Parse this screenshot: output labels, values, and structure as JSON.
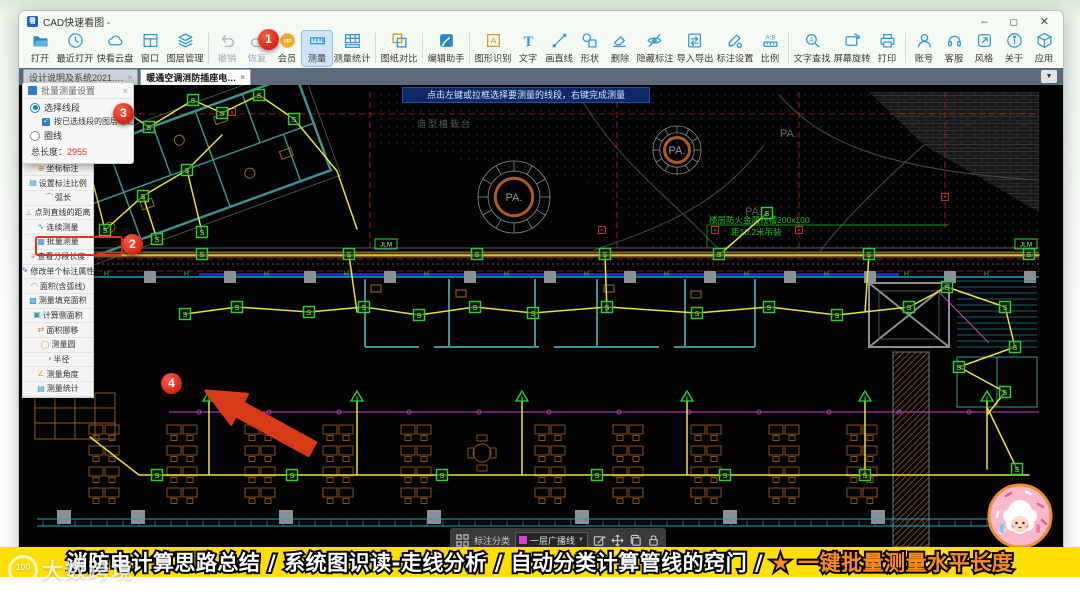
{
  "window": {
    "title": "CAD快速看图 -",
    "app_icon": "kt",
    "controls": {
      "minimize": "–",
      "maximize": "▢",
      "close": "✕"
    }
  },
  "toolbar": {
    "items": [
      {
        "label": "打开",
        "icon": "open-icon"
      },
      {
        "label": "最近打开",
        "icon": "recent-icon"
      },
      {
        "label": "快看云盘",
        "icon": "cloud-icon"
      },
      {
        "label": "窗口",
        "icon": "window-icon"
      },
      {
        "label": "图层管理",
        "icon": "layers-icon",
        "divider_after": true
      },
      {
        "label": "撤销",
        "icon": "undo-icon",
        "disabled": true
      },
      {
        "label": "恢复",
        "icon": "redo-icon",
        "disabled": true
      },
      {
        "label": "会员",
        "icon": "vip-icon"
      },
      {
        "label": "测量",
        "icon": "measure-icon",
        "active": true
      },
      {
        "label": "测量统计",
        "icon": "measure-stats-icon",
        "divider_after": true
      },
      {
        "label": "图纸对比",
        "icon": "compare-icon",
        "divider_after": true
      },
      {
        "label": "编辑助手",
        "icon": "edit-assistant-icon",
        "divider_after": true
      },
      {
        "label": "图形识别",
        "icon": "shape-recognition-icon"
      },
      {
        "label": "文字",
        "icon": "text-icon"
      },
      {
        "label": "画直线",
        "icon": "draw-line-icon"
      },
      {
        "label": "形状",
        "icon": "shapes-icon"
      },
      {
        "label": "删除",
        "icon": "eraser-icon"
      },
      {
        "label": "隐藏标注",
        "icon": "hide-annotations-icon"
      },
      {
        "label": "导入导出",
        "icon": "import-export-icon"
      },
      {
        "label": "标注设置",
        "icon": "annotation-settings-icon"
      },
      {
        "label": "比例",
        "icon": "scale-icon",
        "divider_after": true
      },
      {
        "label": "文字查找",
        "icon": "text-search-icon"
      },
      {
        "label": "屏幕旋转",
        "icon": "screen-rotate-icon"
      },
      {
        "label": "打印",
        "icon": "print-icon",
        "divider_after": true
      },
      {
        "label": "账号",
        "icon": "account-icon"
      },
      {
        "label": "客服",
        "icon": "support-icon"
      },
      {
        "label": "风格",
        "icon": "style-icon"
      },
      {
        "label": "关于",
        "icon": "about-icon"
      },
      {
        "label": "应用",
        "icon": "apps-icon"
      }
    ]
  },
  "tabs": [
    {
      "label": "设计说明及系统2021.…",
      "close": "×",
      "active": false
    },
    {
      "label": "暖通空调消防插座电…",
      "close": "×",
      "active": true
    }
  ],
  "canvas": {
    "tooltip": "点击左键或拉框选择要测量的线段，右键完成测量",
    "labels": {
      "pa": "PA.",
      "planting": "造型植栽台",
      "duct_line1": "楼层防火金属线槽200x100",
      "duct_line2": "距10.2米吊装",
      "device": "S",
      "wall_mark": "H",
      "cable_tag": "JLM"
    }
  },
  "measure_popup": {
    "title": "批量测量设置",
    "close": "×",
    "radio_selected": "选择线段",
    "checkbox_label": "按已选线段的图层过滤",
    "checkbox_mark": "✓",
    "radio_unselected": "圈线",
    "total_label": "总长度：",
    "total_value": "2955"
  },
  "sidebar": {
    "items": [
      {
        "label": "矩形面积",
        "icon": "rect-area-icon",
        "glyph": "▭",
        "color": "#2f8fd0"
      },
      {
        "label": "坐标标注",
        "icon": "coordinate-icon",
        "glyph": "⊕",
        "color": "#e09030"
      },
      {
        "label": "设置标注比例",
        "icon": "annotation-scale-icon",
        "glyph": "▤",
        "color": "#2f8fd0"
      },
      {
        "label": "弧长",
        "icon": "arc-length-icon",
        "glyph": "⌒",
        "color": "#b08030"
      },
      {
        "label": "点到直线的距离",
        "icon": "point-line-distance-icon",
        "glyph": "⊥",
        "color": "#c0a030"
      },
      {
        "label": "连续测量",
        "icon": "continuous-measure-icon",
        "glyph": "∿",
        "color": "#2f8fd0"
      },
      {
        "label": "批量测量",
        "icon": "batch-measure-icon",
        "glyph": "▦",
        "color": "#2f8fd0",
        "highlighted": true
      },
      {
        "label": "查看分段长度",
        "icon": "segment-length-icon",
        "glyph": "≡",
        "color": "#e09030"
      },
      {
        "label": "修改单个标注属性",
        "icon": "modify-annotation-icon",
        "glyph": "✎",
        "color": "#8a5ac0"
      },
      {
        "label": "面积(含弧线)",
        "icon": "area-with-arc-icon",
        "glyph": "◠",
        "color": "#c08a30"
      },
      {
        "label": "测量填充面积",
        "icon": "fill-area-icon",
        "glyph": "▩",
        "color": "#2f8fd0"
      },
      {
        "label": "计算侧面积",
        "icon": "side-area-icon",
        "glyph": "▣",
        "color": "#30a0a0"
      },
      {
        "label": "面积挪移",
        "icon": "area-move-icon",
        "glyph": "⇄",
        "color": "#c08a30"
      },
      {
        "label": "测量圆",
        "icon": "measure-circle-icon",
        "glyph": "◯",
        "color": "#e0a030"
      },
      {
        "label": "半径",
        "icon": "radius-icon",
        "glyph": "◑",
        "color": "#e0a030"
      },
      {
        "label": "测量角度",
        "icon": "measure-angle-icon",
        "glyph": "∠",
        "color": "#c0b030"
      },
      {
        "label": "测量统计",
        "icon": "measure-stats-icon",
        "glyph": "▤",
        "color": "#2f8fd0"
      }
    ]
  },
  "annotations": {
    "step1": "1",
    "step2": "2",
    "step3": "3",
    "step4": "4"
  },
  "bottom_toolbar": {
    "category_label": "标注分类",
    "layer_value": "一层广播线",
    "caret": "▼",
    "swatch_color": "#e33ae3"
  },
  "banner": {
    "text_white": "消防电计算思路总结 / 系统图识读-走线分析 / 自动分类计算管线的窍门 / ",
    "text_orange": "★ 一键批量测量水平长度",
    "bg_color": "#ffdf00",
    "orange_color": "#ff8c1a"
  },
  "watermark": {
    "logo": "100",
    "text": "大数跨境"
  },
  "colors": {
    "accent_blue": "#2f9bd6",
    "annotation_red": "#e8402a",
    "cad_yellow": "#e8e23a",
    "device_green": "#2ed038"
  }
}
